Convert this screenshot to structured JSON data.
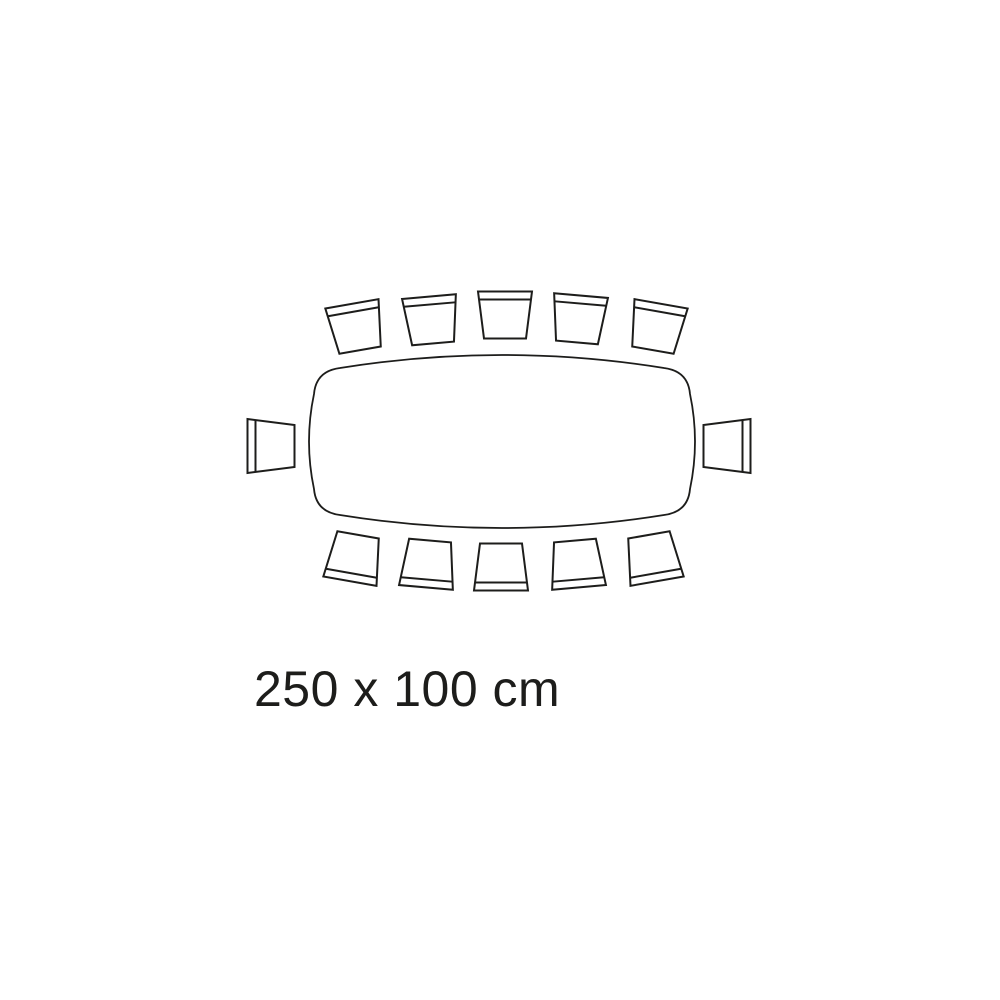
{
  "page": {
    "background_color": "#ffffff"
  },
  "diagram": {
    "type": "table-seating-plan-top-view",
    "label": "250 x 100 cm",
    "seat_count": 12,
    "seats_by_side": {
      "top": 5,
      "bottom": 5,
      "left": 1,
      "right": 1
    },
    "stroke_color": "#1d1d1b",
    "text_color": "#1d1d1b",
    "table": {
      "shape": "rounded rectangle with bowed edges",
      "left": 308,
      "top": 342,
      "right": 696,
      "bottom": 541
    },
    "chairs": [
      {
        "id": "top-1",
        "cx": 356,
        "cy": 327,
        "rotation": -10
      },
      {
        "id": "top-2",
        "cx": 431,
        "cy": 320,
        "rotation": -5
      },
      {
        "id": "top-3",
        "cx": 505,
        "cy": 315,
        "rotation": 0
      },
      {
        "id": "top-4",
        "cx": 579,
        "cy": 319,
        "rotation": 5
      },
      {
        "id": "top-5",
        "cx": 657,
        "cy": 327,
        "rotation": 10
      },
      {
        "id": "right",
        "cx": 727,
        "cy": 446,
        "rotation": 90
      },
      {
        "id": "bottom-1",
        "cx": 354,
        "cy": 558,
        "rotation": 190
      },
      {
        "id": "bottom-2",
        "cx": 428,
        "cy": 564,
        "rotation": 185
      },
      {
        "id": "bottom-3",
        "cx": 501,
        "cy": 567,
        "rotation": 180
      },
      {
        "id": "bottom-4",
        "cx": 577,
        "cy": 564,
        "rotation": 175
      },
      {
        "id": "bottom-5",
        "cx": 653,
        "cy": 558,
        "rotation": 170
      },
      {
        "id": "left",
        "cx": 271,
        "cy": 446,
        "rotation": -90
      }
    ]
  }
}
